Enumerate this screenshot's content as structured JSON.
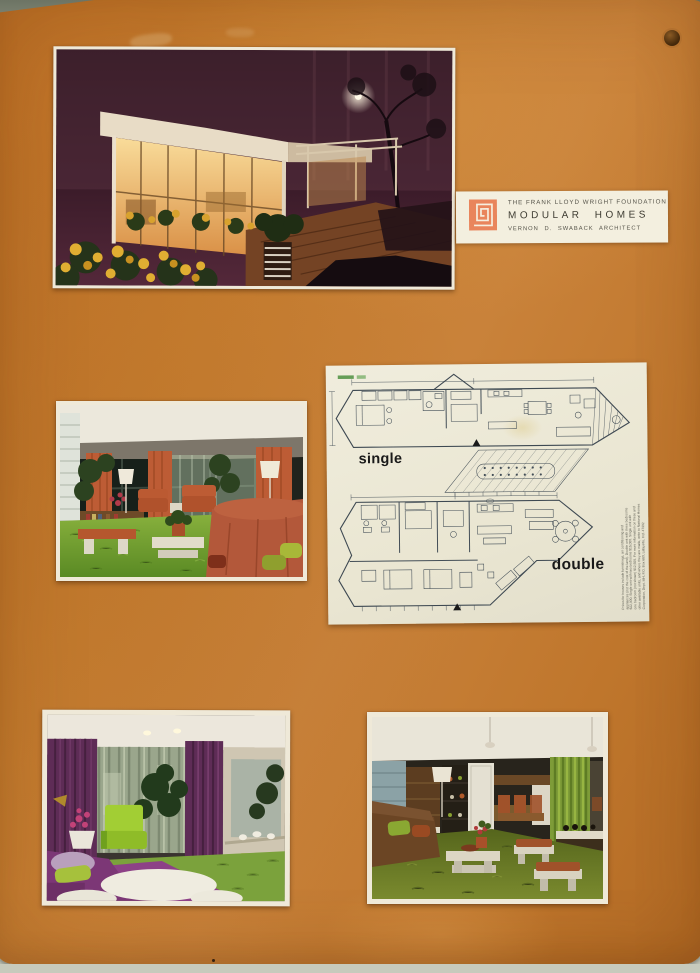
{
  "board": {
    "color": "#c1782e",
    "backdrop_color": "#c4c7b9"
  },
  "label_card": {
    "line1": "THE FRANK LLOYD WRIGHT FOUNDATION",
    "line2": "MODULAR HOMES",
    "line3": "VERNON D. SWABACK ARCHITECT",
    "logo": "flw-square-spiral-icon",
    "logo_color": "#e9855c"
  },
  "floor_plan_sheet": {
    "single_label": "single",
    "double_label": "double",
    "fine_print_lines": [
      "Prices for houses include furnishings, air conditioning and",
      "appliances (not the cost of the land). Double unit with three bedrooms",
      "$22,000. Single unit with two bedrooms $15,000. Single unit with",
      "one bedroom (not shown) $12,500. For more information on these and",
      "other available units, and where they are made, write to National Homes",
      "Corporation, Dept. MH, P.O. Box 680, Lafayette, Ind. 47902"
    ]
  },
  "photos": {
    "exterior": {
      "id": "modular-home-exterior-night"
    },
    "living1": {
      "id": "living-room-orange-green"
    },
    "bedroom": {
      "id": "bedroom-purple-green"
    },
    "living2": {
      "id": "living-dining-olive"
    }
  }
}
